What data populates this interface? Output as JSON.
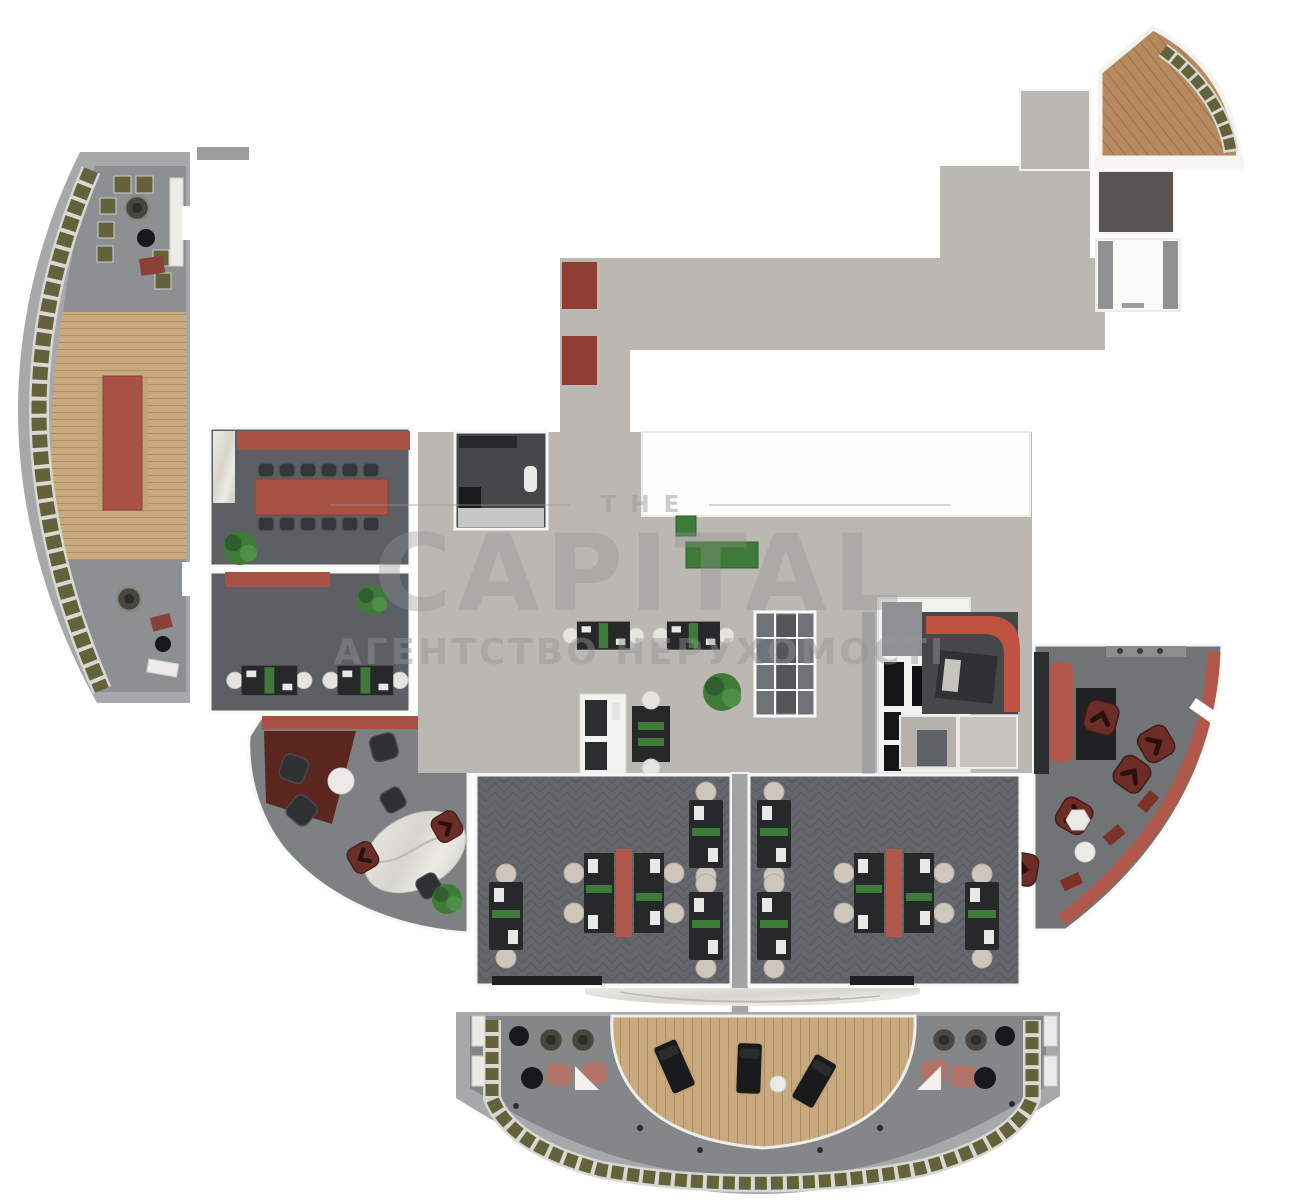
{
  "meta": {
    "type": "architectural-floorplan-3d-render"
  },
  "watermark": {
    "line1": "THE",
    "line2": "CAPITAL",
    "line3": "АГЕНТСТВО НЕРУХОМОСТІ"
  },
  "colors": {
    "canvas_bg": "#ffffff",
    "concrete": "#a6a8aa",
    "stone": "#8d9092",
    "stone_dark": "#84878a",
    "wood": "#c9aa7f",
    "wood_seam": "#ad8d63",
    "wood_dark": "#b68a5e",
    "wood_dark_seam": "#99714b",
    "hall": "#bbb8b3",
    "room_dark": "#5c6064",
    "lounge_floor": "#7e8184",
    "lounge_floor_right": "#717477",
    "office": "#63666a",
    "office_seam": "#585b5f",
    "charcoal": "#45484b",
    "red": "#a85145",
    "red_bright": "#bf5340",
    "red_bench": "#b2584b",
    "carpet_red": "#5c2620",
    "chair_red": "#6b2d26",
    "beige": "#cfc7bb",
    "olive": "#63623a",
    "green": "#3e7a38",
    "green_dark": "#2f5f2c",
    "marble_vein": "#bdbab4",
    "glass": "#6f7276",
    "divider": "#a2a4a6",
    "black": "#17181a",
    "door_gray": "#9a9c9e"
  },
  "regions": [
    "left-terrace",
    "meeting-room",
    "small-office",
    "curved-lounge-left",
    "central-hall",
    "restroom",
    "corridor",
    "glass-meeting-box",
    "wc-block",
    "cafe-booth",
    "kitchen",
    "right-lounge",
    "open-office-left",
    "open-office-right",
    "bottom-terrace",
    "top-right-terrace"
  ]
}
